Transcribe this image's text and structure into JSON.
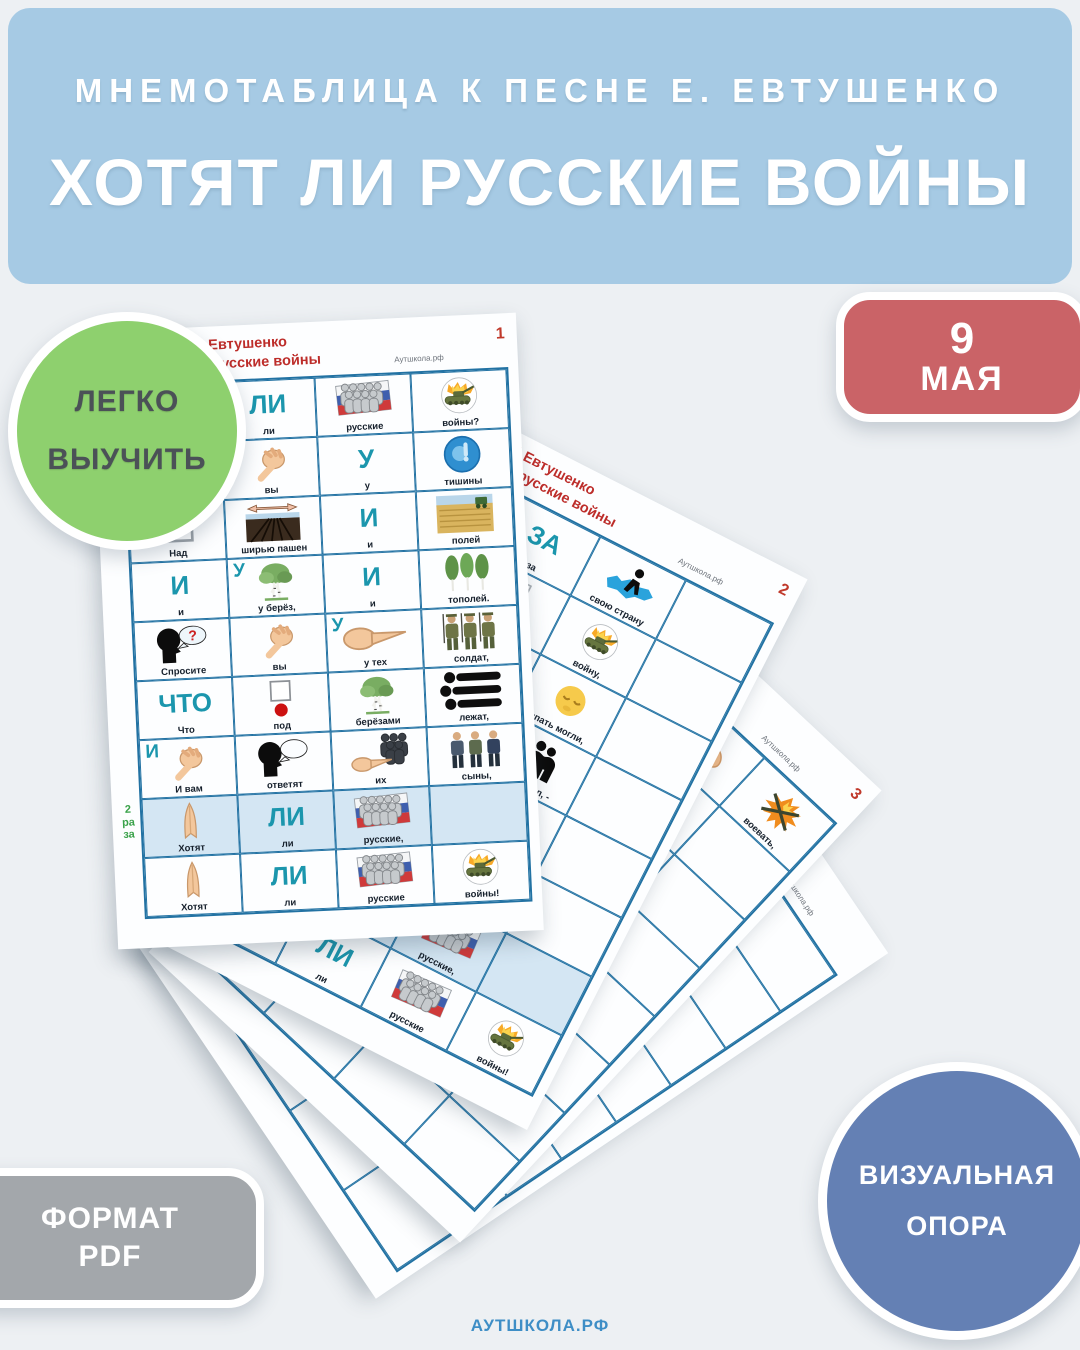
{
  "background": "#edf0f3",
  "header": {
    "bg": "#a6cae4",
    "subtitle": "МНЕМОТАБЛИЦА К ПЕСНЕ Е. ЕВТУШЕНКО",
    "title": "ХОТЯТ ЛИ РУССКИЕ ВОЙНЫ"
  },
  "badges": {
    "easy": {
      "line1": "ЛЕГКО",
      "line2": "ВЫУЧИТЬ",
      "bg": "#8ed06e",
      "fg": "#4b5157"
    },
    "date": {
      "line1": "9",
      "line2": "МАЯ",
      "bg": "#ca6367"
    },
    "format": {
      "line1": "ФОРМАТ",
      "line2": "PDF",
      "bg": "#a3a7ab"
    },
    "visual": {
      "line1": "ВИЗУАЛЬНАЯ",
      "line2": "ОПОРА",
      "bg": "#6480b4"
    }
  },
  "footer": {
    "brand": "АУТШКОЛА.РФ"
  },
  "colors": {
    "accent_teal": "#1b96ad",
    "accent_green": "#3aa24a",
    "table_border": "#2272a3",
    "header_red": "#bd2d2a",
    "shaded_row": "#d4e6f3"
  },
  "sheets": [
    {
      "page_no": "1",
      "author": "Евгений Евтушенко",
      "song": "Хотят ли русские войны",
      "site": "Аутшкола.рф",
      "rows": [
        {
          "cells": [
            {
              "icon": "pray",
              "cap": "Хотят"
            },
            {
              "big": "ЛИ",
              "cap": "ли"
            },
            {
              "icon": "flag-people",
              "cap": "русские"
            },
            {
              "icon": "tank",
              "cap": "войны?"
            }
          ]
        },
        {
          "cells": [
            {
              "icon": "ask-head",
              "cap": "Спросите"
            },
            {
              "icon": "point-you",
              "cap": "вы"
            },
            {
              "big": "У",
              "cap": "у"
            },
            {
              "icon": "shh",
              "cap": "тишины"
            }
          ]
        },
        {
          "cells": [
            {
              "icon": "small-square",
              "cap": "Над"
            },
            {
              "icon": "field-plow",
              "cap": "ширью пашен"
            },
            {
              "big": "И",
              "cap": "и"
            },
            {
              "icon": "field-harvest",
              "cap": "полей"
            }
          ]
        },
        {
          "cells": [
            {
              "big": "И",
              "cap": "и"
            },
            {
              "big": "У",
              "icon": "birch",
              "cap": "у берёз,"
            },
            {
              "big": "И",
              "cap": "и"
            },
            {
              "icon": "poplars",
              "cap": "тополей."
            }
          ]
        },
        {
          "cells": [
            {
              "icon": "ask-head",
              "cap": "Спросите"
            },
            {
              "icon": "point-you",
              "cap": "вы"
            },
            {
              "big": "У",
              "icon": "point-side",
              "cap": "у тех"
            },
            {
              "icon": "soldiers",
              "cap": "солдат,"
            }
          ]
        },
        {
          "cells": [
            {
              "big": "ЧТО",
              "cap": "Что"
            },
            {
              "icon": "under-dot",
              "cap": "под"
            },
            {
              "icon": "birch",
              "cap": "берёзами"
            },
            {
              "icon": "lying",
              "cap": "лежат,"
            }
          ]
        },
        {
          "cells": [
            {
              "big": "И",
              "icon": "point-you",
              "cap": "И вам"
            },
            {
              "icon": "answer-head",
              "cap": "ответят"
            },
            {
              "icon": "hand-soldiers",
              "cap": "их"
            },
            {
              "icon": "sons",
              "cap": "сыны,"
            }
          ]
        },
        {
          "shaded": true,
          "side": [
            "2",
            "ра",
            "за"
          ],
          "cells": [
            {
              "icon": "pray",
              "cap": "Хотят"
            },
            {
              "big": "ЛИ",
              "cap": "ли"
            },
            {
              "icon": "flag-people",
              "cap": "русские,"
            },
            {}
          ]
        },
        {
          "cells": [
            {
              "icon": "pray",
              "cap": "Хотят"
            },
            {
              "big": "ЛИ",
              "cap": "ли"
            },
            {
              "icon": "flag-people",
              "cap": "русские"
            },
            {
              "icon": "tank",
              "cap": "войны!"
            }
          ]
        }
      ]
    },
    {
      "page_no": "2",
      "author": "Евгений Евтушенко",
      "song": "Хотят ли русские войны",
      "site": "Аутшкола.рф",
      "rows": [
        {
          "cells": [
            {
              "big": "НЕ ТОЛЬКО",
              "cap": "только"
            },
            {
              "big": "ЗА",
              "cap": "за"
            },
            {
              "icon": "map-person",
              "cap": "свою страну"
            },
            {}
          ]
        },
        {
          "cells": [
            {
              "icon": "battle",
              "cap": "гибли"
            },
            {
              "icon": "dot-hand",
              "cap": "в ту"
            },
            {
              "icon": "tank",
              "cap": "войну,"
            },
            {}
          ]
        },
        {
          "cells": [
            {
              "icon": "people-black",
              "cap": "люди"
            },
            {
              "icon": "globe",
              "cap": "всей Земли"
            },
            {
              "icon": "moon",
              "cap": "спать могли,"
            },
            {}
          ]
        },
        {
          "cells": [
            {
              "icon": "night-sky",
              "cap": ""
            },
            {
              "icon": "battle",
              "cap": "кто воевал,"
            },
            {
              "icon": "hug",
              "cap": "обнимал, -"
            },
            {}
          ]
        },
        {
          "cells": [
            {
              "icon": "landscape",
              "cap": ""
            },
            {
              "icon": "fist",
              "cap": "верны, -"
            },
            {},
            {}
          ]
        },
        {
          "cells": [
            {},
            {},
            {},
            {}
          ]
        },
        {
          "shaded": true,
          "cells": [
            {
              "icon": "pray",
              "cap": "Хотят"
            },
            {
              "big": "ЛИ",
              "cap": "ли"
            },
            {
              "icon": "flag-people",
              "cap": "русские,"
            },
            {}
          ]
        },
        {
          "cells": [
            {
              "icon": "pray",
              "cap": "Хотят"
            },
            {
              "big": "ЛИ",
              "cap": "ли"
            },
            {
              "icon": "flag-people",
              "cap": "русские"
            },
            {
              "icon": "tank",
              "cap": "войны!"
            }
          ]
        }
      ]
    },
    {
      "page_no": "3",
      "author": "Евгений Евтушенко",
      "song": "Хотят ли русские войны",
      "site": "Аутшкола.рф",
      "rows": [
        {
          "cells": [
            {},
            {
              "icon": "people-black",
              "cap": ""
            },
            {
              "icon": "muscle",
              "cap": "умеем"
            },
            {
              "icon": "guns",
              "cap": "воевать,"
            }
          ]
        },
        {
          "cells": [
            {},
            {
              "big": "ЧТОБЫ",
              "cap": "чтобы"
            },
            {
              "big": "ОПЯТЬ",
              "cap": "опять"
            },
            {}
          ]
        },
        {
          "cells": [
            {
              "icon": "peppers",
              "cap": "горькую"
            },
            {
              "icon": "dot-square",
              "cap": "в"
            },
            {
              "icon": "soldier-run",
              "cap": "бою"
            },
            {}
          ]
        },
        {
          "cells": [
            {
              "icon": "women",
              "cap": "матерей,"
            },
            {
              "icon": "person-black",
              "cap": "свою,"
            },
            {},
            {}
          ]
        },
        {
          "cells": [
            {},
            {},
            {},
            {}
          ]
        },
        {
          "cells": [
            {},
            {},
            {},
            {}
          ]
        },
        {
          "cells": [
            {},
            {},
            {},
            {}
          ]
        },
        {
          "cells": [
            {},
            {},
            {},
            {}
          ]
        }
      ]
    },
    {
      "page_no": "",
      "author": "Евгений Евтушенко",
      "song": "Хотят ли русские войны",
      "site": "Аутшкола.рф",
      "rows": [
        {
          "cells": [
            {},
            {},
            {},
            {}
          ]
        },
        {
          "cells": [
            {},
            {},
            {
              "icon": "horse-man",
              "cap": "батрак,"
            },
            {}
          ]
        },
        {
          "cells": [
            {},
            {},
            {},
            {}
          ]
        },
        {
          "cells": [
            {},
            {},
            {},
            {}
          ]
        },
        {
          "cells": [
            {},
            {},
            {},
            {}
          ]
        },
        {
          "cells": [
            {},
            {},
            {},
            {}
          ]
        },
        {
          "cells": [
            {},
            {},
            {},
            {}
          ]
        },
        {
          "cells": [
            {},
            {},
            {},
            {}
          ]
        }
      ]
    }
  ]
}
